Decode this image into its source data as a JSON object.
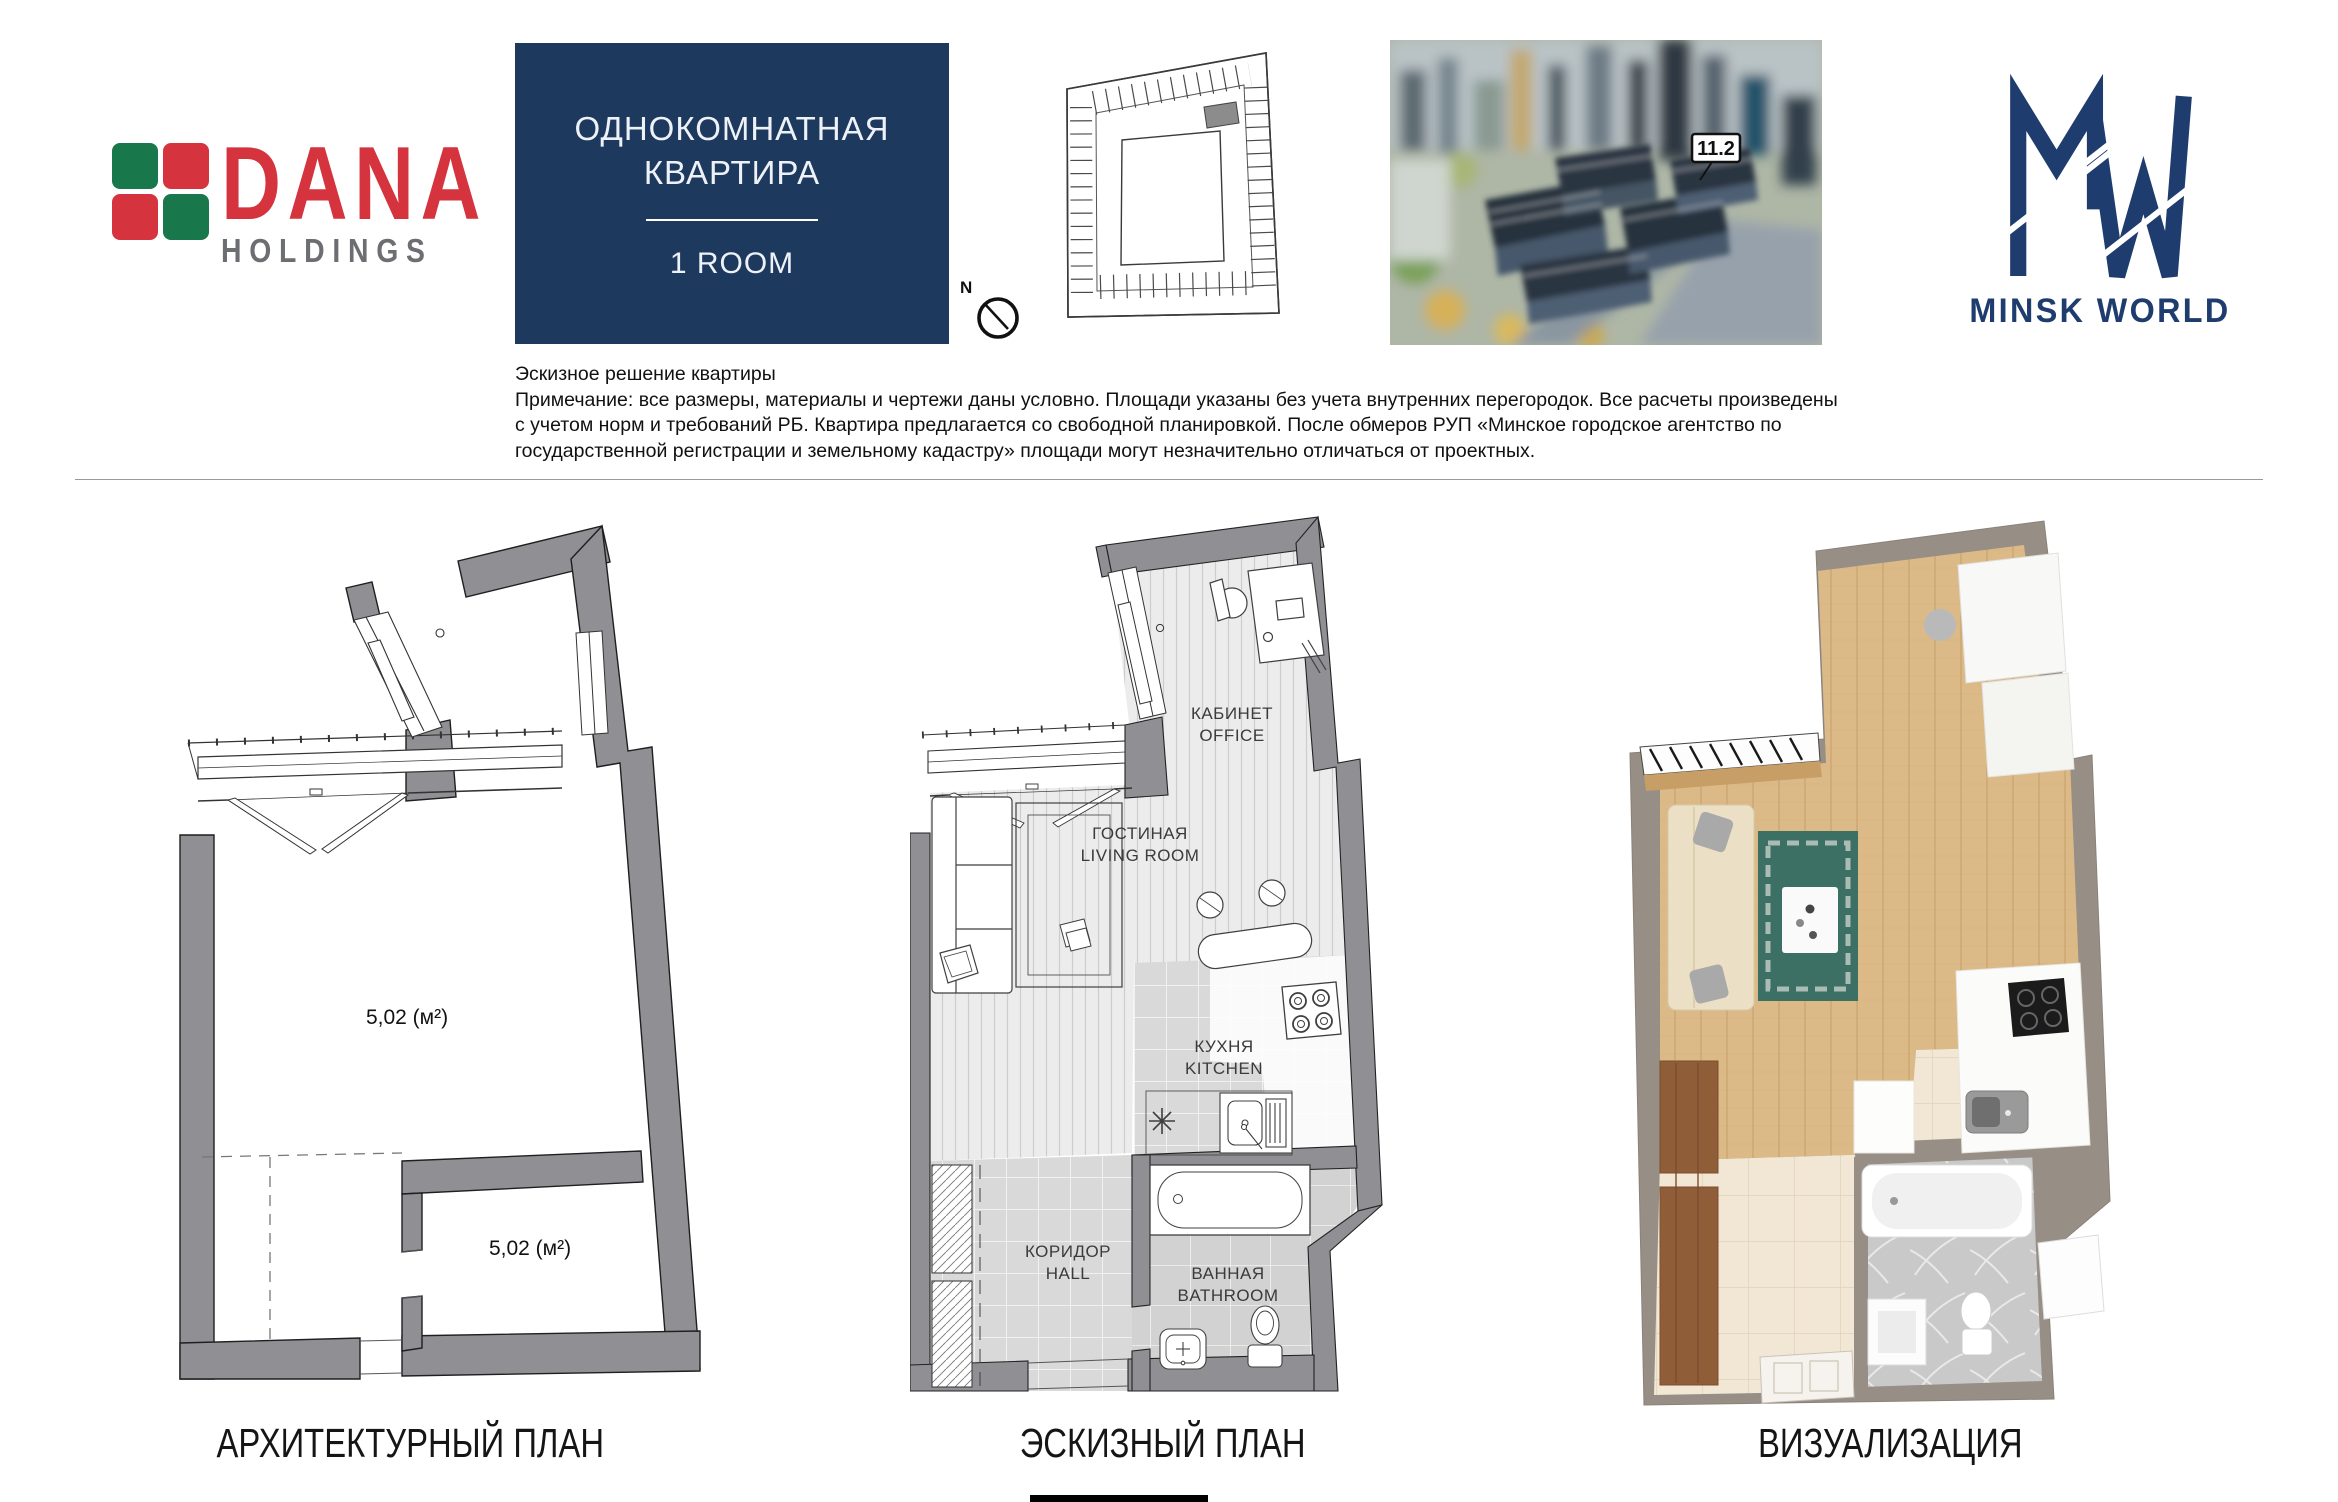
{
  "header": {
    "dana_logo": {
      "name": "DANA",
      "sub": "HOLDINGS"
    },
    "title_box": {
      "line1": "ОДНОКОМНАТНАЯ",
      "line2": "КВАРТИРА",
      "room": "1 ROOM"
    },
    "compass": {
      "north": "N"
    },
    "rendering": {
      "building_label": "11.2"
    },
    "mw_logo": {
      "text": "MINSK WORLD"
    }
  },
  "disclaimer": {
    "l1": "Эскизное решение квартиры",
    "l2": "Примечание: все размеры, материалы и чертежи даны условно. Площади указаны без учета внутренних перегородок. Все расчеты произведены",
    "l3": "с учетом норм и требований РБ. Квартира предлагается со свободной планировкой. После обмеров РУП «Минское городское агентство по",
    "l4": "государственной регистрации и земельному кадастру» площади могут незначительно отличаться от проектных."
  },
  "arch": {
    "caption": "АРХИТЕКТУРНЫЙ ПЛАН",
    "area1": "5,02 (м²)",
    "area2": "5,02 (м²)"
  },
  "sketch": {
    "caption": "ЭСКИЗНЫЙ ПЛАН",
    "office_ru": "КАБИНЕТ",
    "office_en": "OFFICE",
    "living_ru": "ГОСТИНАЯ",
    "living_en": "LIVING ROOM",
    "kitchen_ru": "КУХНЯ",
    "kitchen_en": "KITCHEN",
    "hall_ru": "КОРИДОР",
    "hall_en": "HALL",
    "bath_ru": "ВАННАЯ",
    "bath_en": "BATHROOM"
  },
  "viz": {
    "caption": "ВИЗУАЛИЗАЦИЯ"
  },
  "colors": {
    "navy_box": "#1d3a5e",
    "brand_red": "#d5333e",
    "brand_green": "#19784b",
    "holdings_gray": "#6d6e71",
    "mw_navy": "#1e3c6e",
    "plan_wall_gray": "#8f8f94",
    "viz_wall_taupe": "#978e86"
  }
}
